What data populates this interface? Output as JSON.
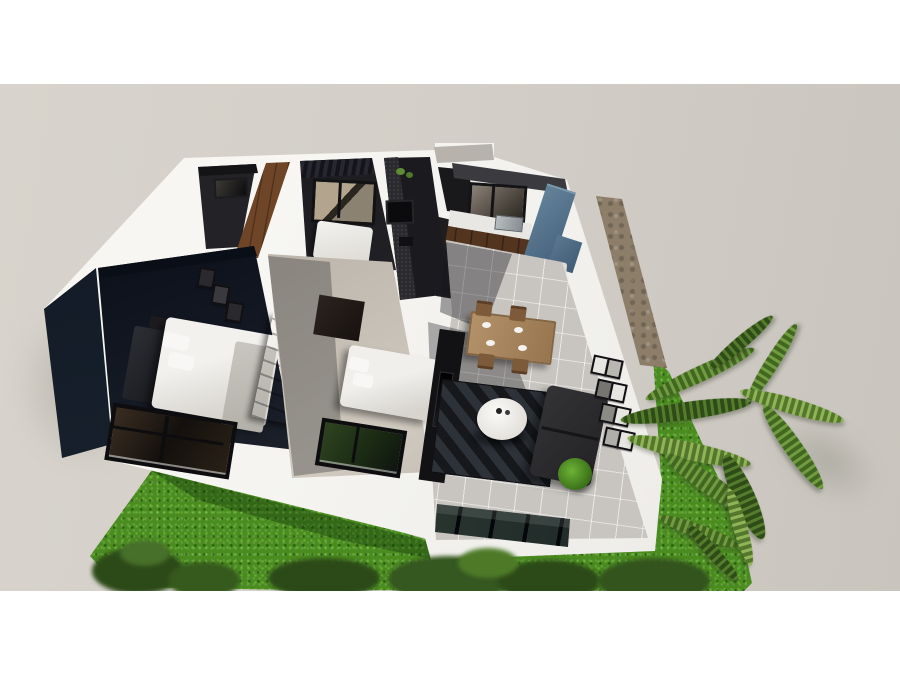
{
  "scene": {
    "title": "Aerial 3D cutaway floor-plan render of a single-story house",
    "style": "photoreal architectural visualization, letterboxed with white bands top and bottom",
    "palette": {
      "letterbox": "#ffffff",
      "ground": "#d2cec7",
      "wall_white": "#f2f1ee",
      "grass_green": "#4a8c1f",
      "path_cobble": "#8d7e69",
      "tile_floor": "#c8c5c0",
      "wood_floor": "#6f4527",
      "navy_wall": "#0e1724",
      "cabinet_blue": "#5e7e93",
      "cabinet_brown": "#53341f",
      "sofa_charcoal": "#2b2b2e",
      "rug_charcoal": "#212428",
      "dining_wood": "#ab8a61",
      "palm_green": "#719c42"
    },
    "rooms": [
      {
        "name": "Closet",
        "features": [
          "dark charcoal walls",
          "small window"
        ]
      },
      {
        "name": "Hallway",
        "features": [
          "brown wood plank floor"
        ]
      },
      {
        "name": "Bedroom 2",
        "features": [
          "full-wall curtains",
          "black-framed window",
          "white double bed"
        ]
      },
      {
        "name": "Bathroom",
        "features": [
          "dark textured accent wall",
          "small window",
          "wall vent"
        ]
      },
      {
        "name": "Kitchen",
        "features": [
          "black-framed window",
          "white counter with sink",
          "brown base cabinets",
          "blue tall cabinets and fridge",
          "white island with plant",
          "4 bar stools",
          "3 black pendant lights",
          "light tile floor"
        ]
      },
      {
        "name": "Master Bedroom",
        "features": [
          "navy walls",
          "double bed with dark headboard",
          "white duvet",
          "3 picture frames",
          "nightstand",
          "brown wardrobe"
        ]
      },
      {
        "name": "Bedroom 3",
        "features": [
          "light walls",
          "brown dresser",
          "white double bed",
          "dark doorway"
        ]
      },
      {
        "name": "Dining Area",
        "features": [
          "wood table",
          "4 wood chairs",
          "4 white place settings"
        ]
      },
      {
        "name": "Living Room",
        "features": [
          "dark TV wall unit",
          "chevron area rug",
          "round white coffee table",
          "charcoal sofa",
          "gallery wall of 8 frames",
          "potted plant",
          "glass front wall"
        ]
      }
    ],
    "exterior": {
      "items": [
        "vivid green lawn",
        "cobblestone side path",
        "palm fronds on the right",
        "dark shrubs along lawn edge",
        "gray entry canopy slab",
        "two black-framed facade windows",
        "glass living-room front"
      ]
    }
  }
}
